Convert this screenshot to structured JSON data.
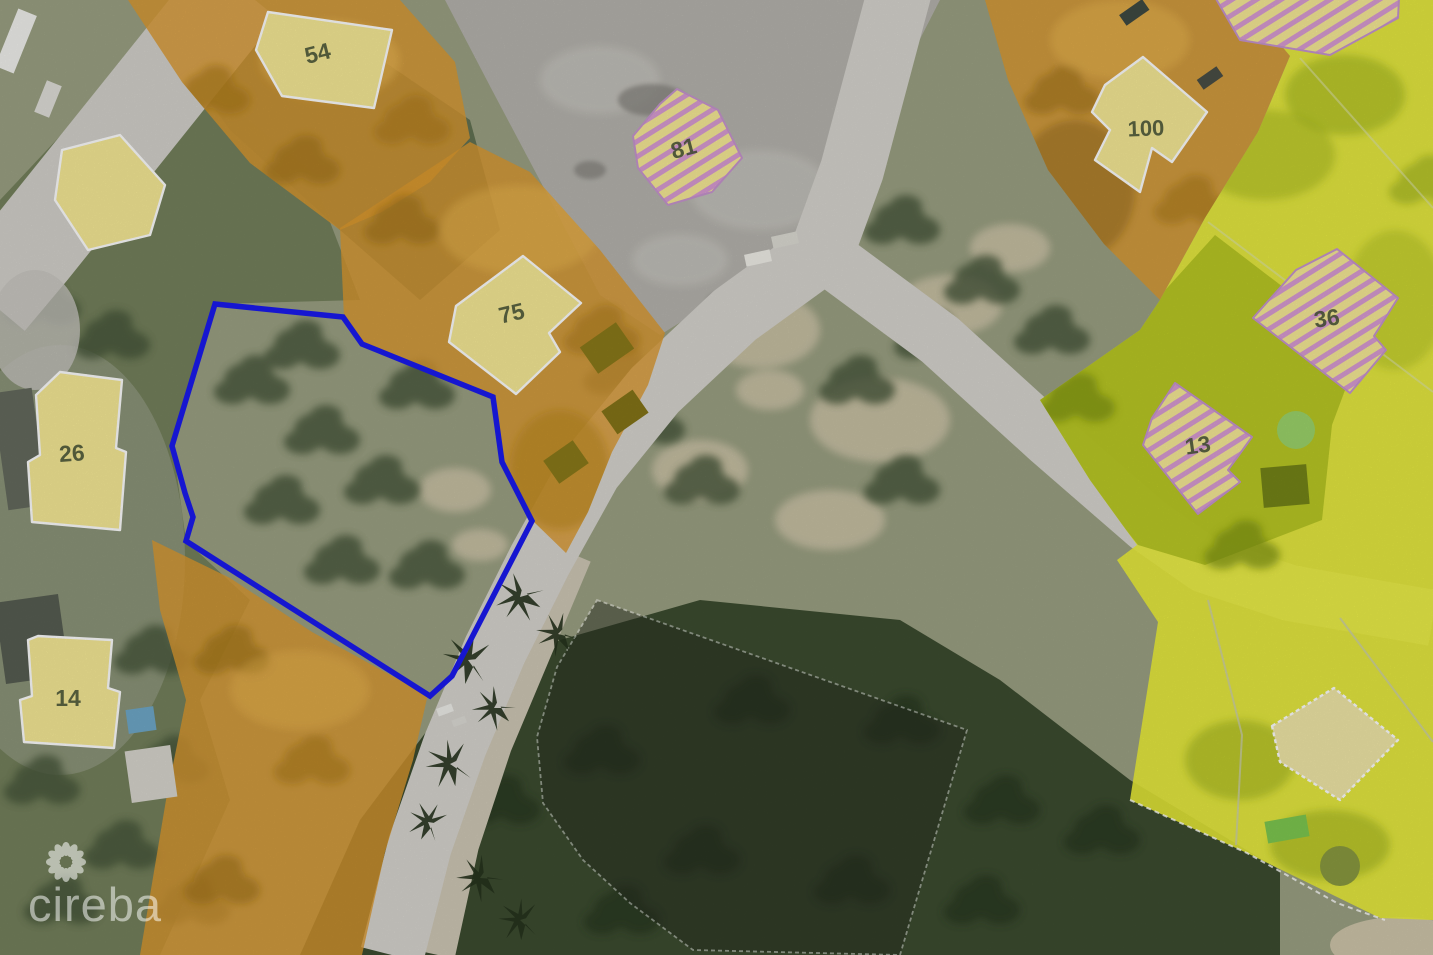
{
  "map": {
    "type": "aerial-parcel-map",
    "watermark": {
      "text": "cireba",
      "logo": "flower-petals-icon"
    },
    "subject_boundary": {
      "color": "#1a1af0",
      "points": "215,304 343,317 362,344 493,397 502,462 532,521 452,676 430,696 186,541 193,517 185,493 172,446"
    },
    "parcels": [
      {
        "label": "54",
        "x": 318,
        "y": 55,
        "rotate": -14
      },
      {
        "label": "81",
        "x": 684,
        "y": 150,
        "rotate": -15
      },
      {
        "label": "75",
        "x": 512,
        "y": 315,
        "rotate": -13
      },
      {
        "label": "100",
        "x": 1146,
        "y": 130,
        "rotate": -2
      },
      {
        "label": "36",
        "x": 1327,
        "y": 320,
        "rotate": -8
      },
      {
        "label": "13",
        "x": 1198,
        "y": 447,
        "rotate": -8
      },
      {
        "label": "26",
        "x": 72,
        "y": 455,
        "rotate": -4
      },
      {
        "label": "14",
        "x": 68,
        "y": 700,
        "rotate": 0
      }
    ],
    "colors": {
      "boundary_blue": "#1a1af0",
      "parcel_orange": "#dd9a2f",
      "parcel_yellow": "#edf139",
      "lawn_olive": "#b5c421",
      "building_fill": "#f7eb97",
      "hatch_stripe": "#d99cd4",
      "hatch_outline": "#c795cf",
      "road_gray": "#d7d5cf",
      "paved_gray": "#b6b4ae",
      "overlay_dark": "#262b20",
      "label_color": "#3e4930",
      "watermark_color": "rgba(255,255,255,0.52)"
    }
  }
}
